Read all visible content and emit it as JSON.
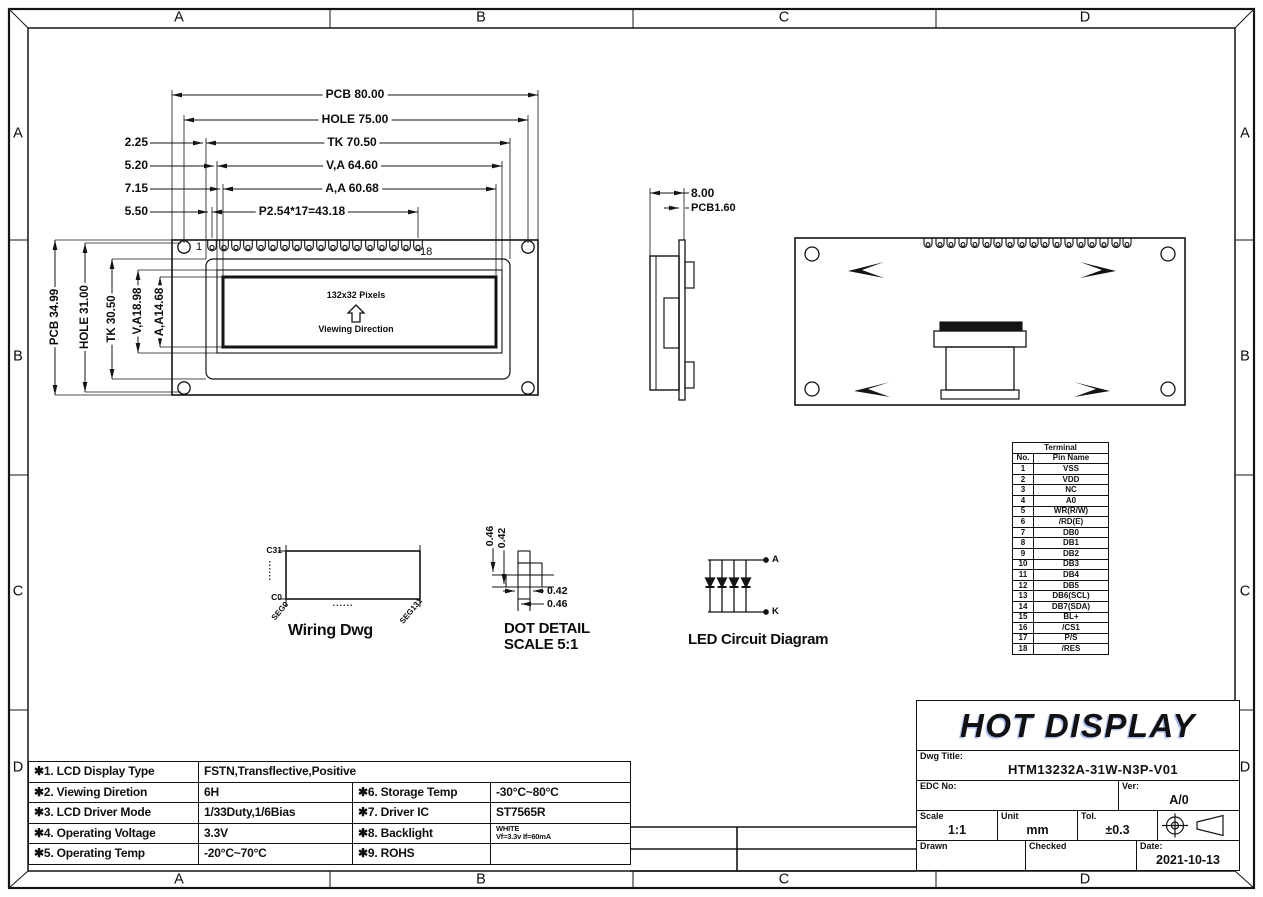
{
  "zones": {
    "letters": [
      "A",
      "B",
      "C",
      "D"
    ]
  },
  "front_view": {
    "dims_top": {
      "pcb": "PCB 80.00",
      "hole": "HOLE 75.00",
      "tk": "TK 70.50",
      "va": "V,A 64.60",
      "aa": "A,A 60.68",
      "pitch": "P2.54*17=43.18"
    },
    "offsets": {
      "o1": "2.25",
      "o2": "5.20",
      "o3": "7.15",
      "o4": "5.50"
    },
    "dims_side": {
      "pcb": "PCB 34.99",
      "hole": "HOLE 31.00",
      "tk": "TK 30.50",
      "va": "V,A18.98",
      "aa": "A,A14.68"
    },
    "pin_first": "1",
    "pin_last": "18",
    "display_label": "132x32 Pixels",
    "viewing_label": "Viewing Direction"
  },
  "side_view": {
    "dim_width": "8.00",
    "dim_pcb": "PCB1.60"
  },
  "wiring": {
    "caption": "Wiring Dwg",
    "com_top": "C31",
    "com_bottom": "C0",
    "seg_left": "SEG0",
    "seg_right": "SEG131",
    "dots_v": "......",
    "dots_h": "......"
  },
  "dot_detail": {
    "caption1": "DOT DETAIL",
    "caption2": "SCALE 5:1",
    "v1": "0.46",
    "v2": "0.42",
    "h1": "0.42",
    "h2": "0.46"
  },
  "led": {
    "caption": "LED Circuit Diagram",
    "anode": "A",
    "cathode": "K"
  },
  "terminal": {
    "title": "Terminal",
    "col_no": "No.",
    "col_name": "Pin Name",
    "rows": [
      [
        "1",
        "VSS"
      ],
      [
        "2",
        "VDD"
      ],
      [
        "3",
        "NC"
      ],
      [
        "4",
        "A0"
      ],
      [
        "5",
        "WR(R/W)"
      ],
      [
        "6",
        "/RD(E)"
      ],
      [
        "7",
        "DB0"
      ],
      [
        "8",
        "DB1"
      ],
      [
        "9",
        "DB2"
      ],
      [
        "10",
        "DB3"
      ],
      [
        "11",
        "DB4"
      ],
      [
        "12",
        "DB5"
      ],
      [
        "13",
        "DB6(SCL)"
      ],
      [
        "14",
        "DB7(SDA)"
      ],
      [
        "15",
        "BL+"
      ],
      [
        "16",
        "/CS1"
      ],
      [
        "17",
        "P/S"
      ],
      [
        "18",
        "/RES"
      ]
    ]
  },
  "specs": {
    "r1_label": "✱1. LCD Display Type",
    "r1_value": "FSTN,Transflective,Positive",
    "r2_label": "✱2. Viewing Diretion",
    "r2_value": "6H",
    "r2_label2": "✱6. Storage Temp",
    "r2_value2": "-30°C~80°C",
    "r3_label": "✱3. LCD Driver Mode",
    "r3_value": "1/33Duty,1/6Bias",
    "r3_label2": "✱7. Driver IC",
    "r3_value2": "ST7565R",
    "r4_label": "✱4. Operating Voltage",
    "r4_value": "3.3V",
    "r4_label2": "✱8. Backlight",
    "r4_value2a": "WHITE",
    "r4_value2b": "Vf=3.3v If=60mA",
    "r5_label": "✱5. Operating Temp",
    "r5_value": "-20°C~70°C",
    "r5_label2": "✱9. ROHS",
    "r5_value2": ""
  },
  "title_block": {
    "company": "HOT DISPLAY",
    "dwg_title_label": "Dwg Title:",
    "dwg_title": "HTM13232A-31W-N3P-V01",
    "edc_label": "EDC No:",
    "ver_label": "Ver:",
    "ver": "A/0",
    "scale_label": "Scale",
    "scale": "1:1",
    "unit_label": "Unit",
    "unit": "mm",
    "tol_label": "Tol.",
    "tol": "±0.3",
    "drawn_label": "Drawn",
    "checked_label": "Checked",
    "date_label": "Date:",
    "date": "2021-10-13"
  }
}
